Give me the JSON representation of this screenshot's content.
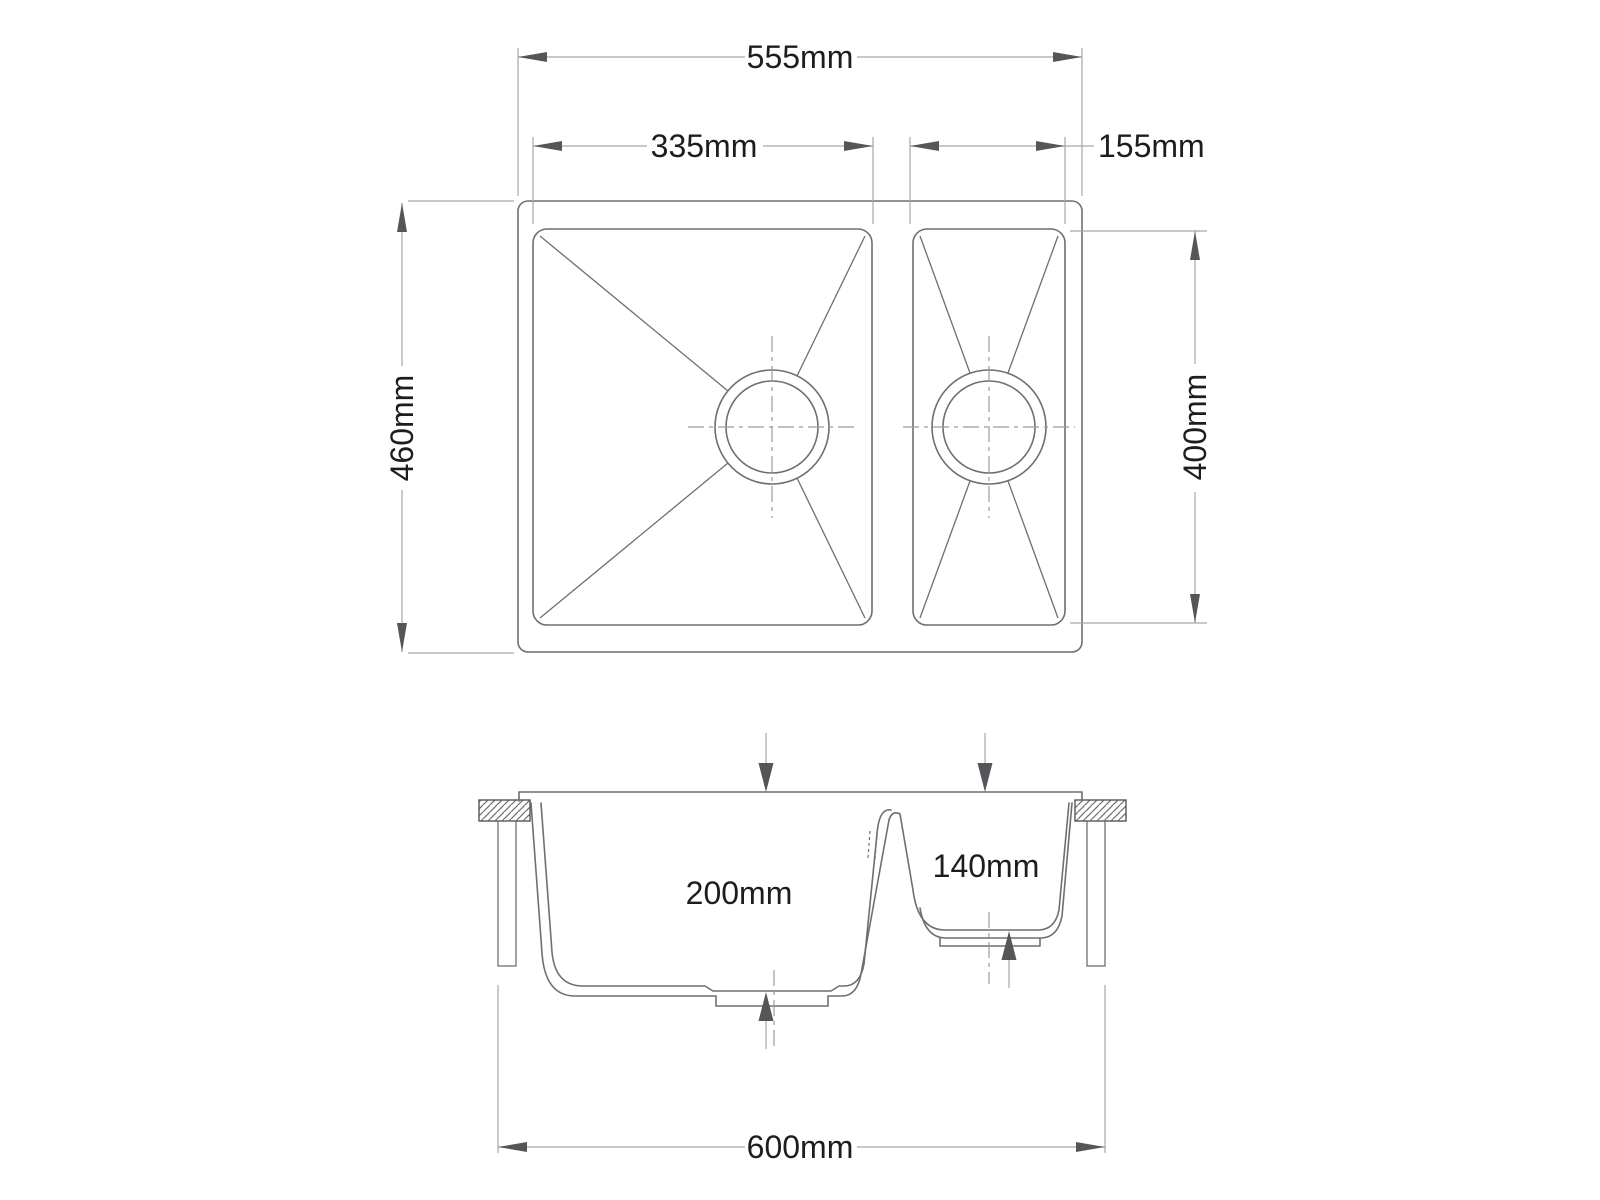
{
  "drawing": {
    "colors": {
      "background": "#ffffff",
      "object_line": "#6e6f72",
      "dimension_line": "#a6a7aa",
      "arrow": "#55565a",
      "text": "#1d1d1f"
    },
    "top_view": {
      "labels": {
        "overall_width": "555mm",
        "main_bowl_width": "335mm",
        "second_bowl_width": "155mm",
        "overall_depth": "460mm",
        "bowl_front_to_back": "400mm"
      }
    },
    "section_view": {
      "labels": {
        "main_bowl_depth": "200mm",
        "second_bowl_depth": "140mm",
        "overall_length": "600mm"
      }
    }
  }
}
